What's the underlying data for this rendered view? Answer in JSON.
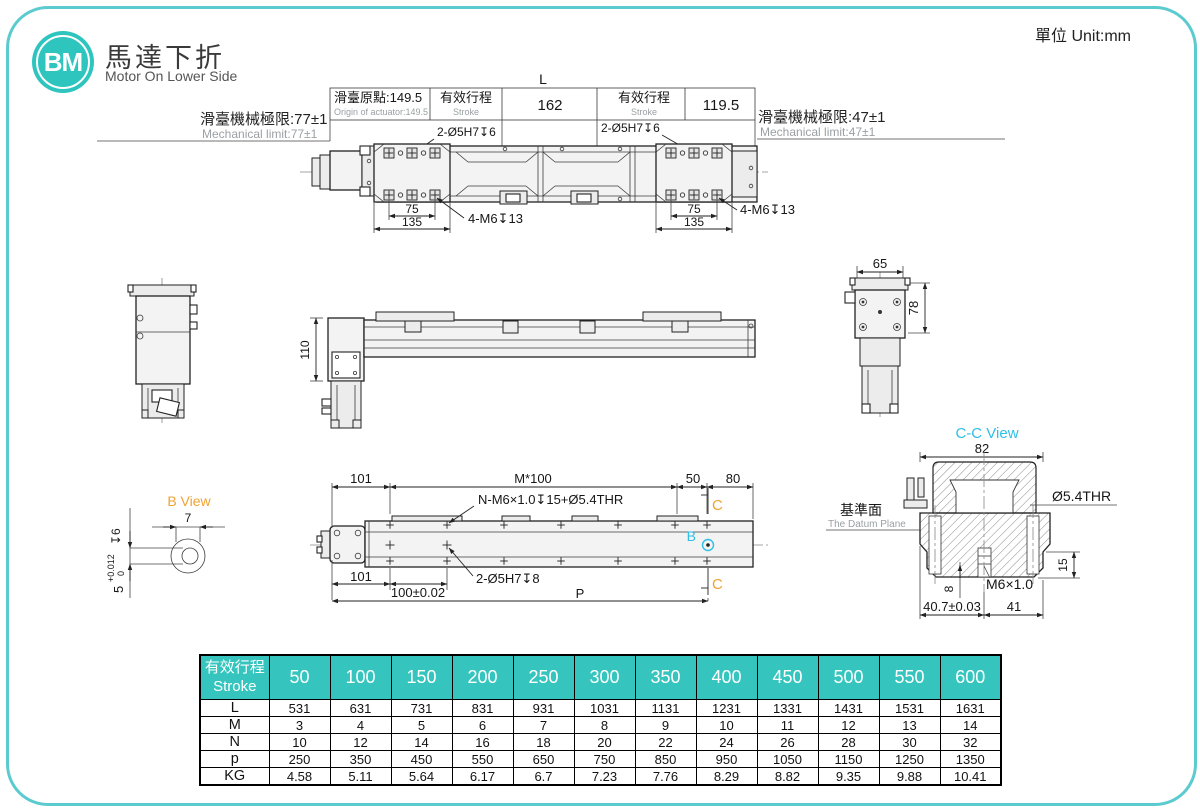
{
  "colors": {
    "teal": "#2EC5BE",
    "table_teal": "#35C5BE",
    "border_teal": "#5BCBD0",
    "orange": "#F0A233",
    "cyan": "#2FBFE7",
    "gray": "#9aa0a3"
  },
  "header": {
    "logo_text": "BM",
    "title_zh": "馬達下折",
    "title_en": "Motor On Lower Side",
    "unit_label": "單位 Unit:mm"
  },
  "top_view": {
    "dim_overall": "L",
    "origin_zh": "滑臺原點:149.5",
    "origin_en": "Origin of actuator:149.5",
    "stroke_zh": "有效行程",
    "stroke_en": "Stroke",
    "dim_mid": "162",
    "dim_right": "119.5",
    "limit_left_zh": "滑臺機械極限:77±1",
    "limit_left_en": "Mechanical limit:77±1",
    "limit_right_zh": "滑臺機械極限:47±1",
    "limit_right_en": "Mechanical limit:47±1",
    "hole_callout": "2-Ø5H7↧6",
    "screw_callout": "4-M6↧13",
    "dim_75": "75",
    "dim_135": "135"
  },
  "side_view": {
    "dim_height": "110"
  },
  "end_view": {
    "dim_width": "65",
    "dim_height": "78"
  },
  "b_view": {
    "title": "B View",
    "dim_width": "7",
    "dim_bore": "5",
    "tol_upper": "+0.012",
    "tol_lower": "0",
    "depth": "↧6"
  },
  "plan_view": {
    "dim_left_top": "101",
    "dim_pitch": "M*100",
    "dim_50": "50",
    "dim_80": "80",
    "callout_holes": "N-M6×1.0↧15+Ø5.4THR",
    "callout_pins": "2-Ø5H7↧8",
    "dim_left_bottom": "101",
    "dim_100": "100±0.02",
    "dim_p": "P",
    "marker_b": "B",
    "marker_c": "C"
  },
  "cc_view": {
    "title": "C-C View",
    "dim_82": "82",
    "callout_thr": "Ø5.4THR",
    "datum_zh": "基準面",
    "datum_en": "The Datum Plane",
    "dim_15": "15",
    "dim_8": "8",
    "thread": "M6×1.0",
    "dim_40_7": "40.7±0.03",
    "dim_41": "41"
  },
  "table": {
    "header_zh": "有效行程",
    "header_en": "Stroke",
    "stroke_columns": [
      "50",
      "100",
      "150",
      "200",
      "250",
      "300",
      "350",
      "400",
      "450",
      "500",
      "550",
      "600"
    ],
    "rows": [
      {
        "label": "L",
        "values": [
          "531",
          "631",
          "731",
          "831",
          "931",
          "1031",
          "1131",
          "1231",
          "1331",
          "1431",
          "1531",
          "1631"
        ]
      },
      {
        "label": "M",
        "values": [
          "3",
          "4",
          "5",
          "6",
          "7",
          "8",
          "9",
          "10",
          "11",
          "12",
          "13",
          "14"
        ]
      },
      {
        "label": "N",
        "values": [
          "10",
          "12",
          "14",
          "16",
          "18",
          "20",
          "22",
          "24",
          "26",
          "28",
          "30",
          "32"
        ]
      },
      {
        "label": "p",
        "values": [
          "250",
          "350",
          "450",
          "550",
          "650",
          "750",
          "850",
          "950",
          "1050",
          "1150",
          "1250",
          "1350"
        ]
      },
      {
        "label": "KG",
        "values": [
          "4.58",
          "5.11",
          "5.64",
          "6.17",
          "6.7",
          "7.23",
          "7.76",
          "8.29",
          "8.82",
          "9.35",
          "9.88",
          "10.41"
        ]
      }
    ]
  }
}
